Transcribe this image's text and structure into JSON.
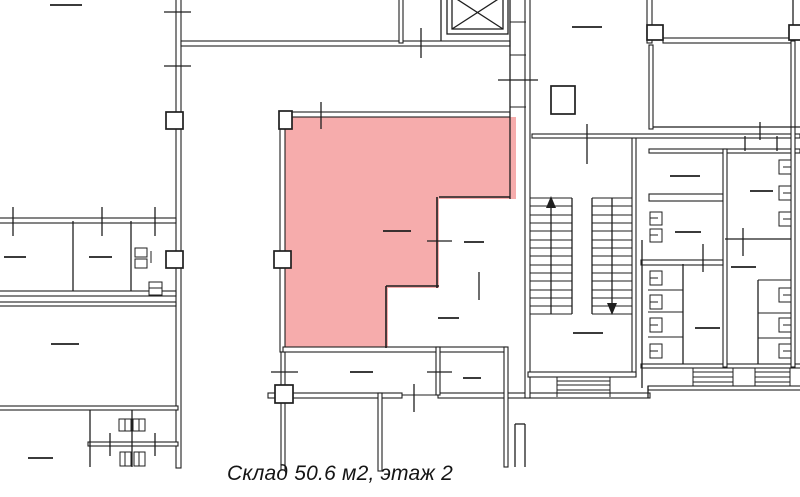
{
  "plan": {
    "caption": "Склад 50.6 м2, этаж 2",
    "highlighted_room": {
      "label": "Склад",
      "area": "50.6 м2",
      "floor": "этаж 2"
    },
    "highlight_color": "#F6ACAC",
    "wall_color": "#1F1F1F",
    "background_color": "#FFFFFF"
  }
}
